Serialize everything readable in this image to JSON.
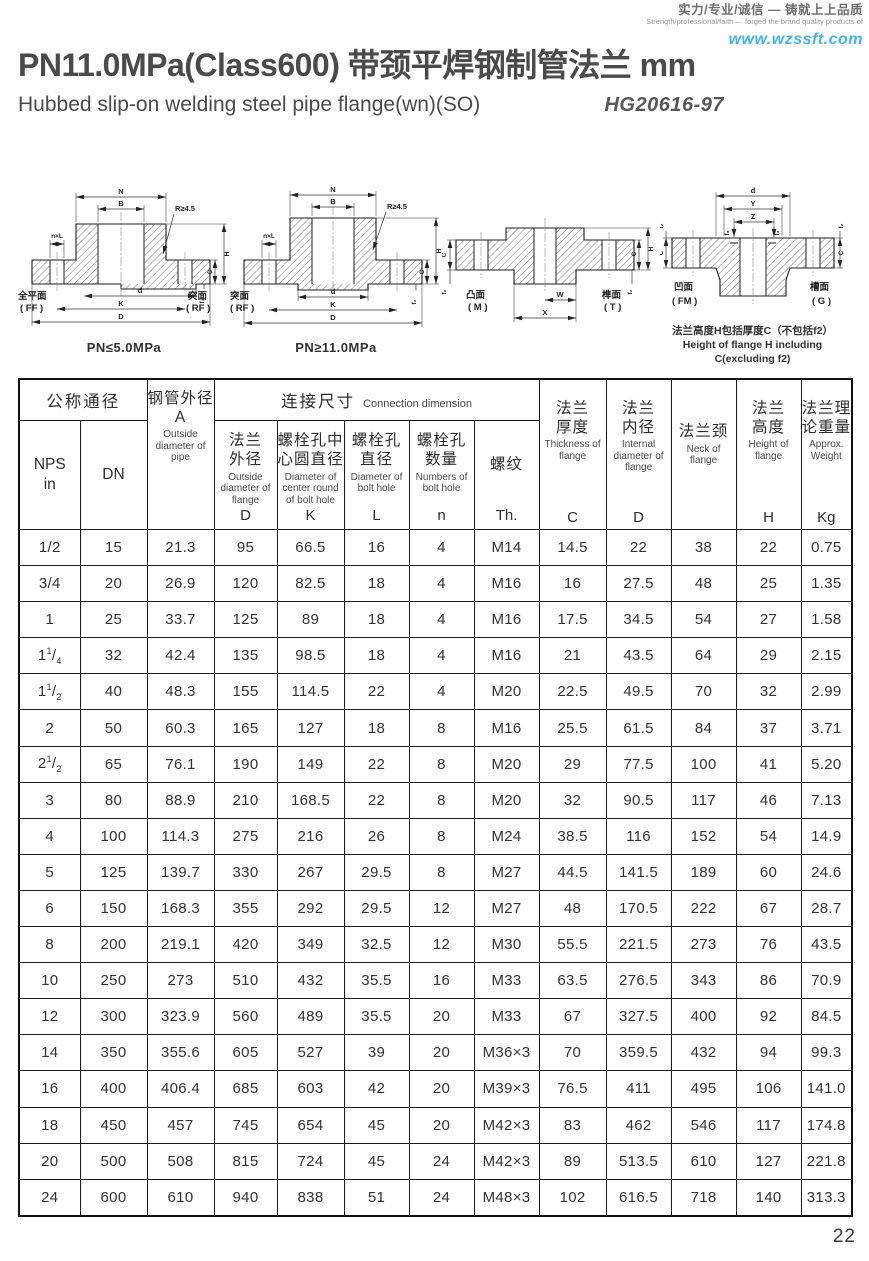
{
  "brand": {
    "slogan_cn": "实力/专业/诚信 — 铸就上上品质",
    "slogan_en": "Strength/professional/faith — forged the brand quality products of",
    "website": "www.wzssft.com"
  },
  "header": {
    "title": "PN11.0MPa(Class600) 带颈平焊钢制管法兰  mm",
    "subtitle": "Hubbed slip-on welding steel pipe flange(wn)(SO)",
    "standard": "HG20616-97"
  },
  "drawings": [
    {
      "caption": "PN≤5.0MPa",
      "face_left": {
        "cn": "全平面",
        "code": "( FF )"
      },
      "face_right": {
        "cn": "突面",
        "code": "( RF )"
      },
      "labels": {
        "N": "N",
        "B": "B",
        "nxL": "n×L",
        "R": "R≥4.5",
        "d": "d",
        "K": "K",
        "D": "D",
        "H": "H",
        "C": "C",
        "f1": "f₁"
      }
    },
    {
      "caption": "PN≥11.0MPa",
      "face_left": {
        "cn": "突面",
        "code": "( RF )"
      },
      "labels": {
        "N": "N",
        "B": "B",
        "nxL": "n×L",
        "R": "R≥4.5",
        "d": "d",
        "K": "K",
        "D": "D",
        "H": "H",
        "C": "C",
        "f2": "f₂"
      }
    },
    {
      "face_left": {
        "cn": "凸面",
        "code": "( M )"
      },
      "face_right": {
        "cn": "榫面",
        "code": "( T )"
      },
      "labels": {
        "W": "W",
        "X": "X",
        "H": "H",
        "C_left": "C",
        "C_right": "C",
        "f2_left": "f₂",
        "f2_right": "f₂"
      }
    },
    {
      "face_left": {
        "cn": "凹面",
        "code": "( FM )"
      },
      "face_right": {
        "cn": "槽面",
        "code": "( G )"
      },
      "labels": {
        "d": "d",
        "Y": "Y",
        "Z": "Z",
        "f3_left": "f₃",
        "f3_right": "f₃",
        "f2_left": "f₂",
        "f2_right": "f₂",
        "C_left": "C",
        "C_right": "C"
      },
      "note_cn": "法兰高度H包括厚度C（不包括f2）",
      "note_en": "Height of flange H including C(excluding f2)"
    }
  ],
  "table": {
    "top": {
      "nominal": "公称通径",
      "connection_cn": "连接尺寸",
      "connection_en": "Connection dimension"
    },
    "cols": {
      "nps": {
        "l1": "NPS",
        "l2": "in"
      },
      "dn": "DN",
      "pipe_od": {
        "cn": "钢管外径",
        "letter": "A",
        "en": "Outside diameter of pipe"
      },
      "flange_od": {
        "cn": "法兰\n外径",
        "en": "Outside diameter of flange",
        "letter": "D"
      },
      "bolt_circle": {
        "cn": "螺栓孔中\n心圆直径",
        "en": "Diameter of center round of bolt hole",
        "letter": "K"
      },
      "bolt_hole_dia": {
        "cn": "螺栓孔\n直径",
        "en": "Diameter of bolt hole",
        "letter": "L"
      },
      "bolt_hole_num": {
        "cn": "螺栓孔\n数量",
        "en": "Numbers of bolt hole",
        "letter": "n"
      },
      "thread": {
        "cn": "螺纹",
        "en": "",
        "letter": "Th."
      },
      "thickness": {
        "cn": "法兰\n厚度",
        "en": "Thickness of flange",
        "letter": "C"
      },
      "internal_dia": {
        "cn": "法兰\n内径",
        "en": "Internal diameter of flange",
        "letter": "D"
      },
      "neck": {
        "cn": "法兰颈",
        "en": "Neck of flange",
        "letter": ""
      },
      "height": {
        "cn": "法兰\n高度",
        "en": "Height of flange",
        "letter": "H"
      },
      "weight": {
        "cn": "法兰理\n论重量",
        "en": "Approx. Weight",
        "letter": "Kg"
      }
    },
    "col_keys": [
      "nps",
      "dn",
      "pipe_od",
      "flange_od",
      "bolt_circle",
      "bolt_hole_dia",
      "bolt_hole_num",
      "thread",
      "thickness",
      "internal_dia",
      "neck",
      "height",
      "weight"
    ],
    "rows": [
      [
        "1/2",
        "15",
        "21.3",
        "95",
        "66.5",
        "16",
        "4",
        "M14",
        "14.5",
        "22",
        "38",
        "22",
        "0.75"
      ],
      [
        "3/4",
        "20",
        "26.9",
        "120",
        "82.5",
        "18",
        "4",
        "M16",
        "16",
        "27.5",
        "48",
        "25",
        "1.35"
      ],
      [
        "1",
        "25",
        "33.7",
        "125",
        "89",
        "18",
        "4",
        "M16",
        "17.5",
        "34.5",
        "54",
        "27",
        "1.58"
      ],
      [
        "1 1/4",
        "32",
        "42.4",
        "135",
        "98.5",
        "18",
        "4",
        "M16",
        "21",
        "43.5",
        "64",
        "29",
        "2.15"
      ],
      [
        "1 1/2",
        "40",
        "48.3",
        "155",
        "114.5",
        "22",
        "4",
        "M20",
        "22.5",
        "49.5",
        "70",
        "32",
        "2.99"
      ],
      [
        "2",
        "50",
        "60.3",
        "165",
        "127",
        "18",
        "8",
        "M16",
        "25.5",
        "61.5",
        "84",
        "37",
        "3.71"
      ],
      [
        "2 1/2",
        "65",
        "76.1",
        "190",
        "149",
        "22",
        "8",
        "M20",
        "29",
        "77.5",
        "100",
        "41",
        "5.20"
      ],
      [
        "3",
        "80",
        "88.9",
        "210",
        "168.5",
        "22",
        "8",
        "M20",
        "32",
        "90.5",
        "117",
        "46",
        "7.13"
      ],
      [
        "4",
        "100",
        "114.3",
        "275",
        "216",
        "26",
        "8",
        "M24",
        "38.5",
        "116",
        "152",
        "54",
        "14.9"
      ],
      [
        "5",
        "125",
        "139.7",
        "330",
        "267",
        "29.5",
        "8",
        "M27",
        "44.5",
        "141.5",
        "189",
        "60",
        "24.6"
      ],
      [
        "6",
        "150",
        "168.3",
        "355",
        "292",
        "29.5",
        "12",
        "M27",
        "48",
        "170.5",
        "222",
        "67",
        "28.7"
      ],
      [
        "8",
        "200",
        "219.1",
        "420",
        "349",
        "32.5",
        "12",
        "M30",
        "55.5",
        "221.5",
        "273",
        "76",
        "43.5"
      ],
      [
        "10",
        "250",
        "273",
        "510",
        "432",
        "35.5",
        "16",
        "M33",
        "63.5",
        "276.5",
        "343",
        "86",
        "70.9"
      ],
      [
        "12",
        "300",
        "323.9",
        "560",
        "489",
        "35.5",
        "20",
        "M33",
        "67",
        "327.5",
        "400",
        "92",
        "84.5"
      ],
      [
        "14",
        "350",
        "355.6",
        "605",
        "527",
        "39",
        "20",
        "M36×3",
        "70",
        "359.5",
        "432",
        "94",
        "99.3"
      ],
      [
        "16",
        "400",
        "406.4",
        "685",
        "603",
        "42",
        "20",
        "M39×3",
        "76.5",
        "411",
        "495",
        "106",
        "141.0"
      ],
      [
        "18",
        "450",
        "457",
        "745",
        "654",
        "45",
        "20",
        "M42×3",
        "83",
        "462",
        "546",
        "117",
        "174.8"
      ],
      [
        "20",
        "500",
        "508",
        "815",
        "724",
        "45",
        "24",
        "M42×3",
        "89",
        "513.5",
        "610",
        "127",
        "221.8"
      ],
      [
        "24",
        "600",
        "610",
        "940",
        "838",
        "51",
        "24",
        "M48×3",
        "102",
        "616.5",
        "718",
        "140",
        "313.3"
      ]
    ]
  },
  "footer": {
    "page_number": "22"
  }
}
